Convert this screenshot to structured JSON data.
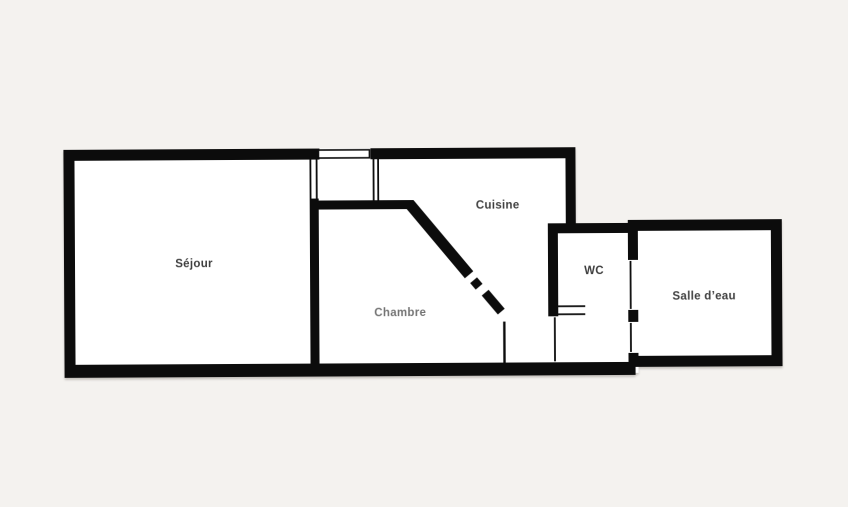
{
  "canvas": {
    "width": 848,
    "height": 507
  },
  "colors": {
    "background": "#f4f2ef",
    "room_fill": "#ffffff",
    "wall": "#0c0c0c",
    "label": "#3e3e3e"
  },
  "floorplan": {
    "type": "apartment-floor-plan",
    "rooms": [
      {
        "id": "sejour",
        "label": "Séjour"
      },
      {
        "id": "chambre",
        "label": "Chambre"
      },
      {
        "id": "cuisine",
        "label": "Cuisine"
      },
      {
        "id": "wc",
        "label": "WC"
      },
      {
        "id": "salle_deau",
        "label": "Salle d’eau"
      }
    ]
  }
}
